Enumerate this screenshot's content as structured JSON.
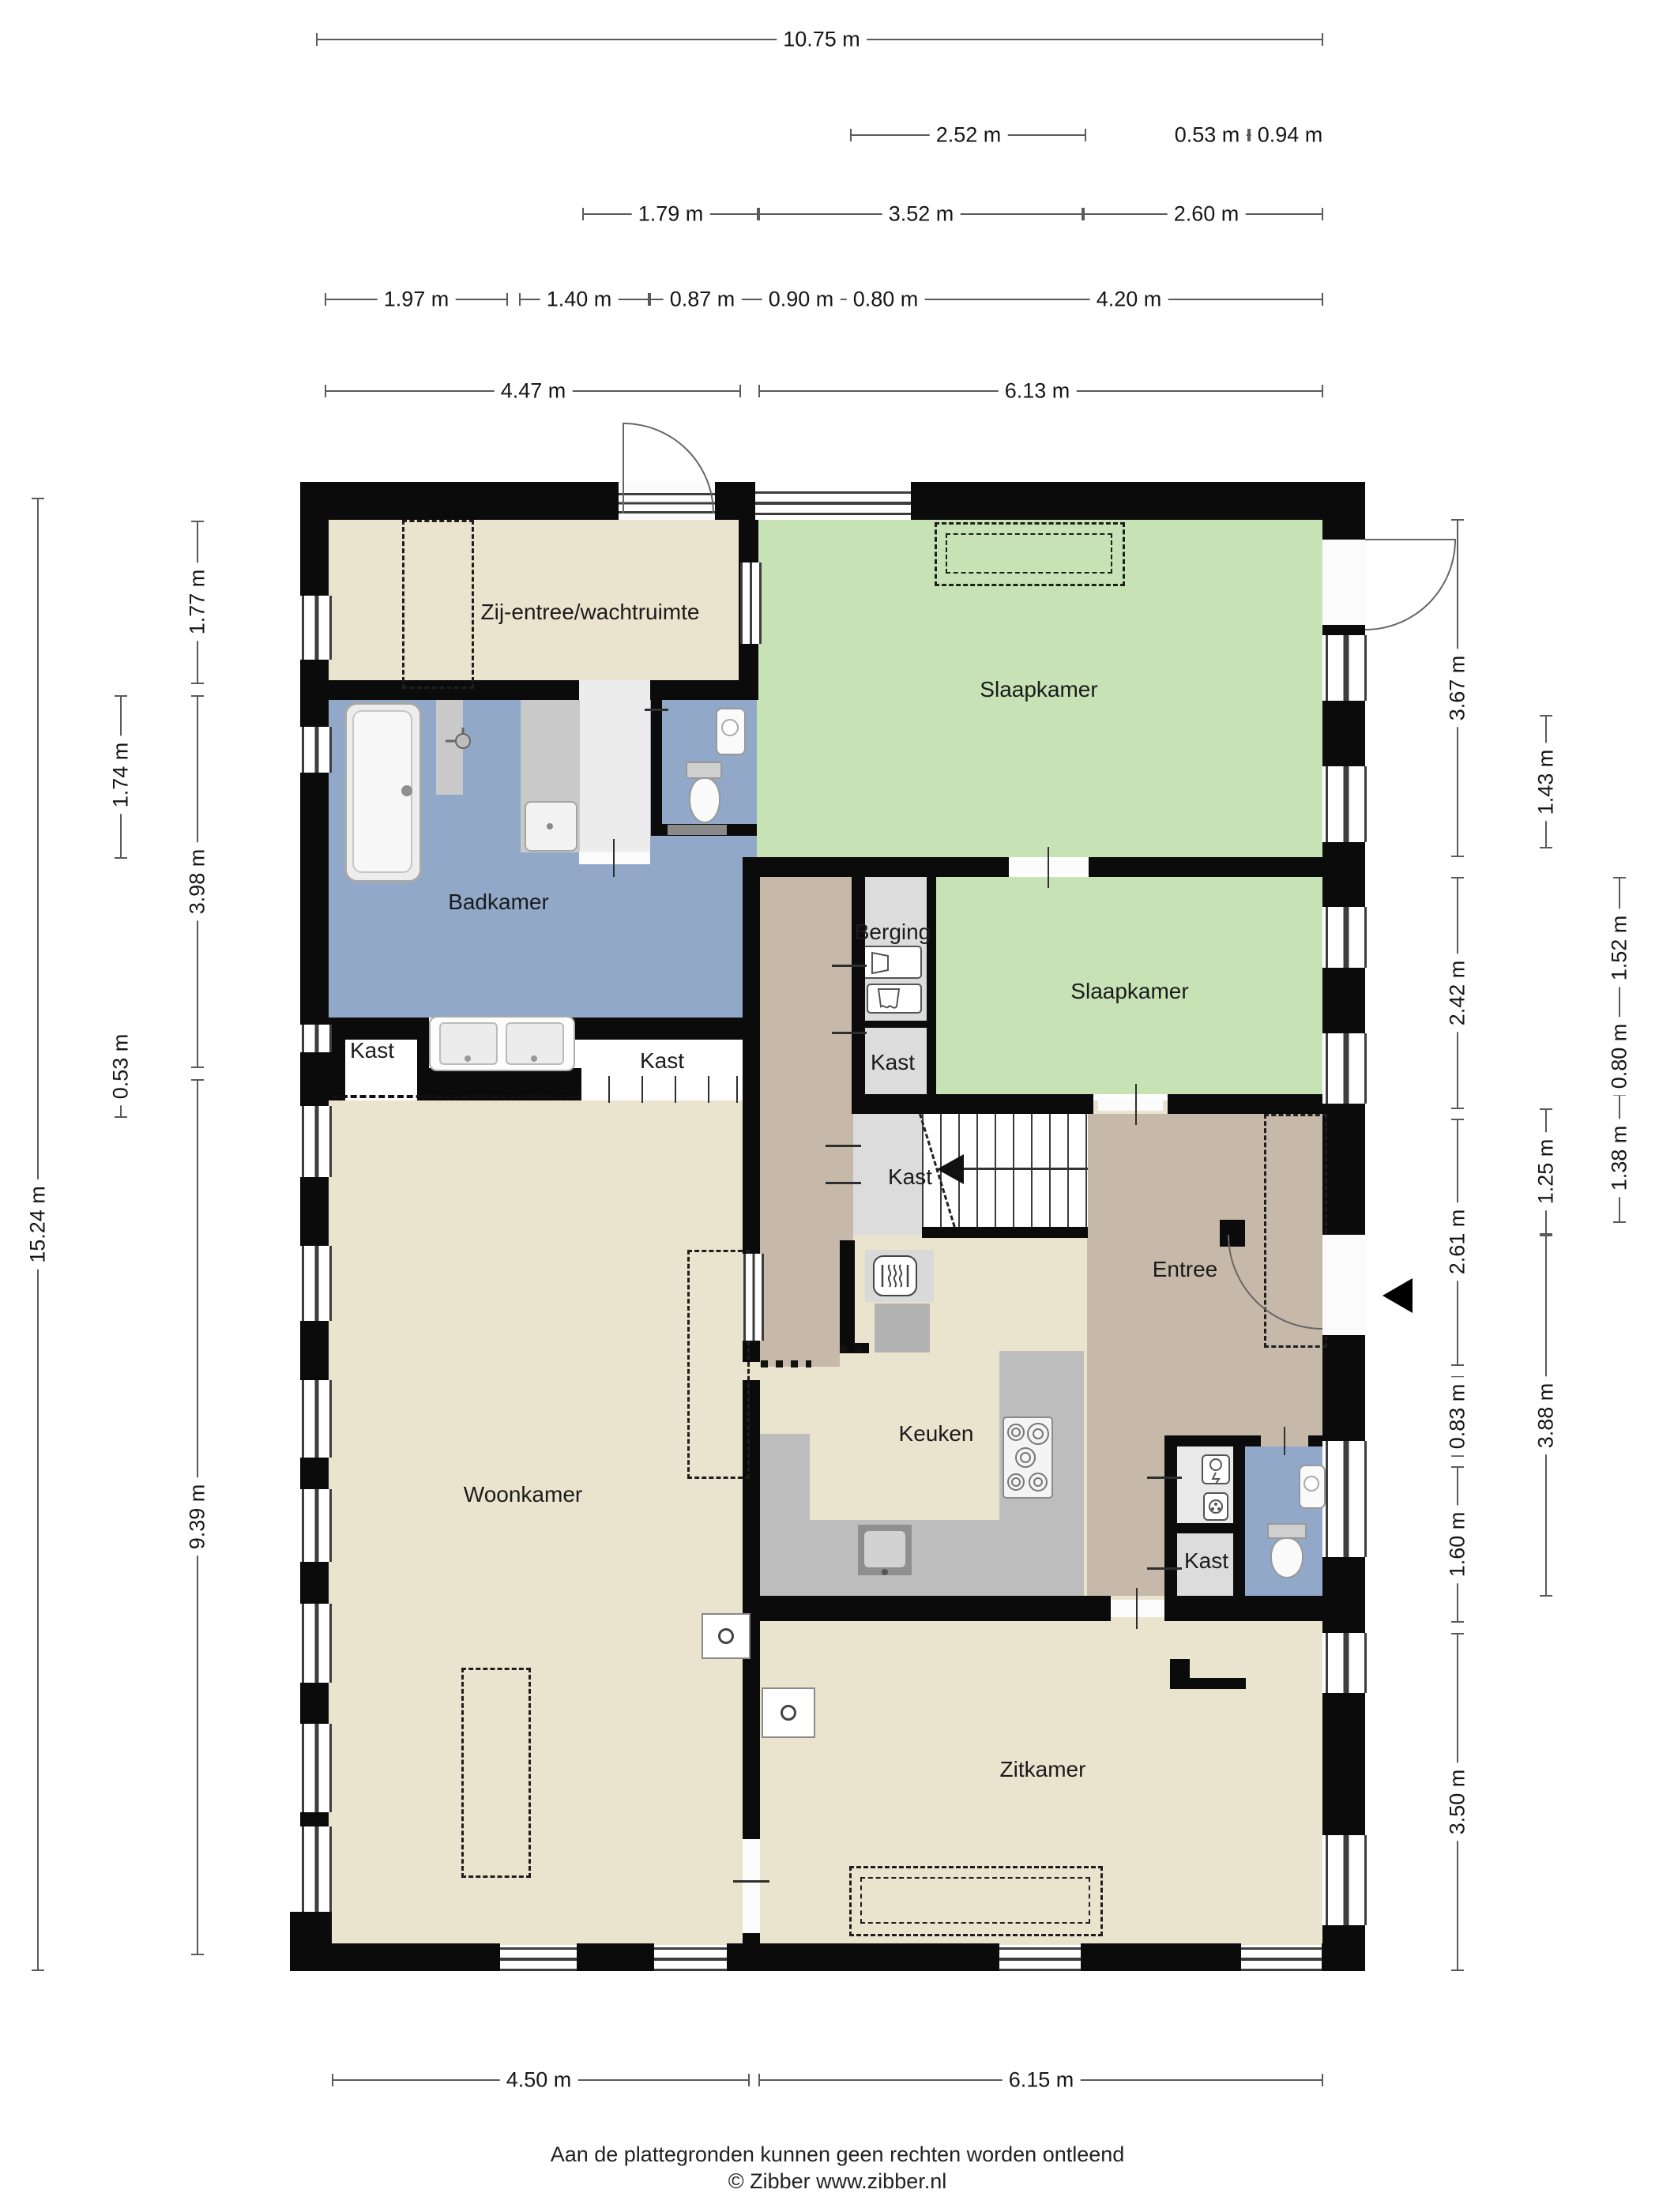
{
  "plan_type": "floor-plan",
  "rooms": {
    "zij_entree": "Zij-entree/wachtruimte",
    "slaapkamer_1": "Slaapkamer",
    "badkamer": "Badkamer",
    "berging": "Berging",
    "slaapkamer_2": "Slaapkamer",
    "kast_1": "Kast",
    "kast_2": "Kast",
    "kast_3": "Kast",
    "kast_4": "Kast",
    "kast_5": "Kast",
    "entree": "Entree",
    "keuken": "Keuken",
    "woonkamer": "Woonkamer",
    "zitkamer": "Zitkamer"
  },
  "dims": {
    "top_total": "10.75 m",
    "top_a": "2.52 m",
    "top_b": "0.53 m",
    "top_c": "0.94 m",
    "top_d": "1.79 m",
    "top_e": "3.52 m",
    "top_f": "2.60 m",
    "top_g": "1.97 m",
    "top_h": "1.40 m",
    "top_i": "0.87 m",
    "top_j": "0.90 m",
    "top_k": "0.80 m",
    "top_l": "4.20 m",
    "top_m": "4.47 m",
    "top_n": "6.13 m",
    "left_total": "15.24 m",
    "left_a": "1.74 m",
    "left_b": "0.53 m",
    "left_c": "1.77 m",
    "left_d": "3.98 m",
    "left_e": "9.39 m",
    "right_a": "3.67 m",
    "right_b": "1.43 m",
    "right_c": "2.42 m",
    "right_d": "1.52 m",
    "right_e": "0.80 m",
    "right_f": "1.38 m",
    "right_g": "1.25 m",
    "right_h": "2.61 m",
    "right_i": "0.83 m",
    "right_j": "3.88 m",
    "right_k": "1.60 m",
    "right_l": "3.50 m",
    "bottom_a": "4.50 m",
    "bottom_b": "6.15 m"
  },
  "footer": {
    "disclaimer": "Aan de plattegronden kunnen geen rechten worden ontleend",
    "copyright": "© Zibber www.zibber.nl"
  },
  "colors": {
    "floor_living": "#eae3cd",
    "floor_bedroom": "#c7e2b5",
    "floor_bath": "#91a8c8",
    "floor_hall": "#c7b9a9",
    "floor_storage": "#dcdcdc",
    "counter": "#bdbdbd",
    "wall": "#0b0b0b"
  }
}
